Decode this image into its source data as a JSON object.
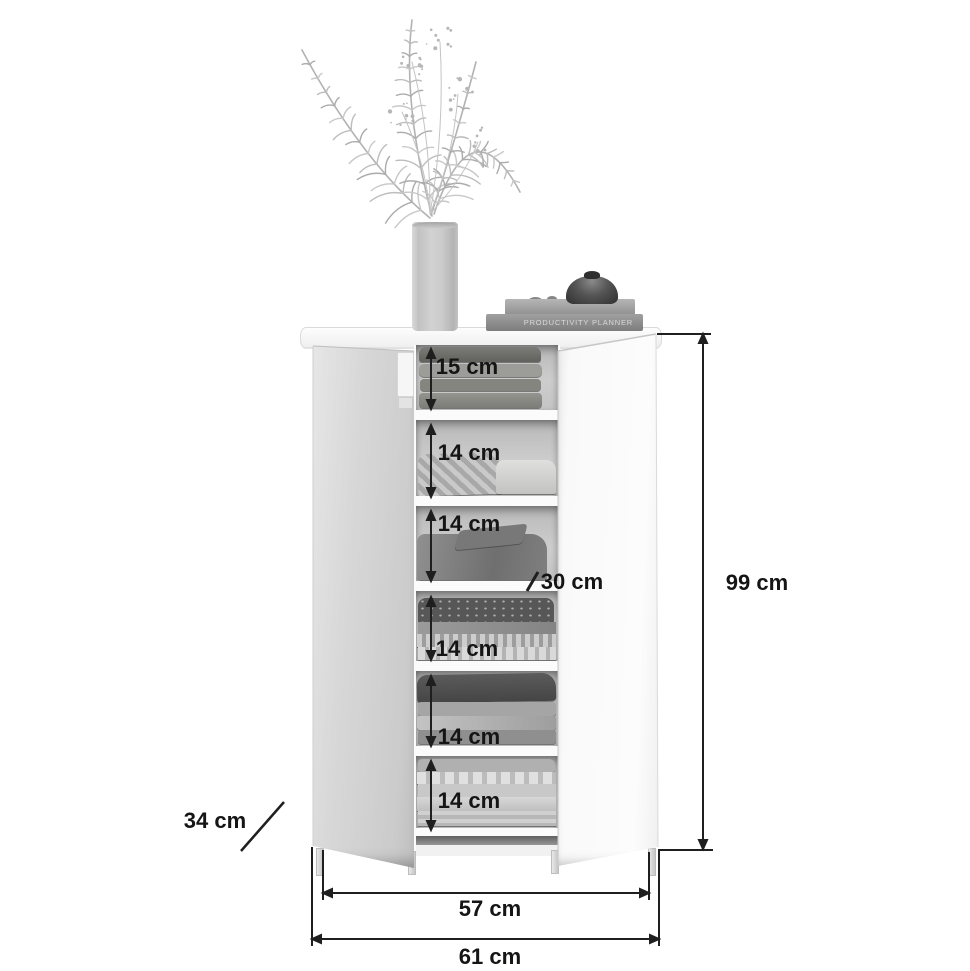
{
  "diagram_type": "furniture-dimension-diagram",
  "product": "storage cabinet with two open doors, six shelf compartments with folded clothes",
  "shelf_labels": [
    "15 cm",
    "14 cm",
    "14 cm",
    "14 cm",
    "14 cm",
    "14 cm"
  ],
  "other_dims": {
    "depth_label": "30 cm",
    "height_label": "99 cm",
    "side_depth_label": "34 cm",
    "inner_width_label": "57 cm",
    "outer_width_label": "61 cm"
  },
  "decor": {
    "book_spine": "PRODUCTIVITY PLANNER",
    "items": [
      "palm-plant-in-vase",
      "book-stack",
      "dark-bowl",
      "pebbles"
    ]
  },
  "colors": {
    "background": "#ffffff",
    "dimension_lines": "#1f1f1f",
    "label_text": "#151515",
    "cabinet_white": "#fafafa",
    "door_gray": "#d2d2d2",
    "interior_gray": "#c6c6c6"
  }
}
